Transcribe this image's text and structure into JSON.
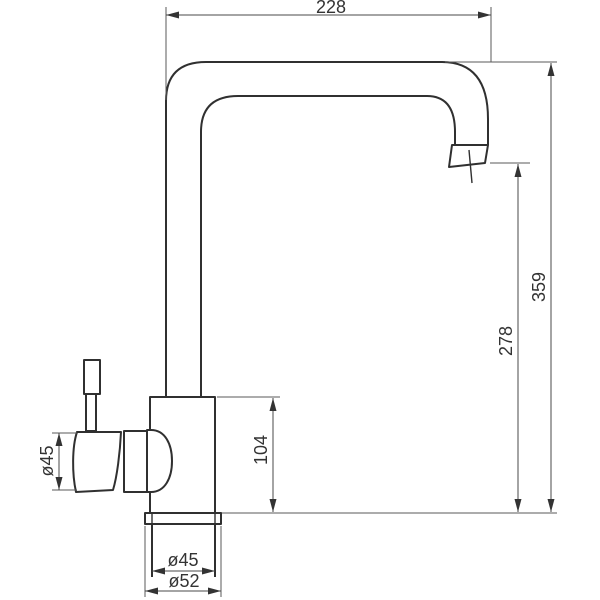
{
  "drawing": {
    "type": "technical-dimension-drawing",
    "subject": "single-lever kitchen mixer tap, side elevation with dimensions",
    "dimensions": {
      "spout_reach": "228",
      "overall_height": "359",
      "spout_outlet_height": "278",
      "body_height": "104",
      "handle_diameter": "ø45",
      "shank_diameter": "ø45",
      "flange_diameter": "ø52"
    },
    "colors": {
      "outline": "#303030",
      "dimension_lines": "#4a4a4a",
      "baseline": "#7a7a7a",
      "label_text": "#333333",
      "background": "#ffffff"
    }
  }
}
